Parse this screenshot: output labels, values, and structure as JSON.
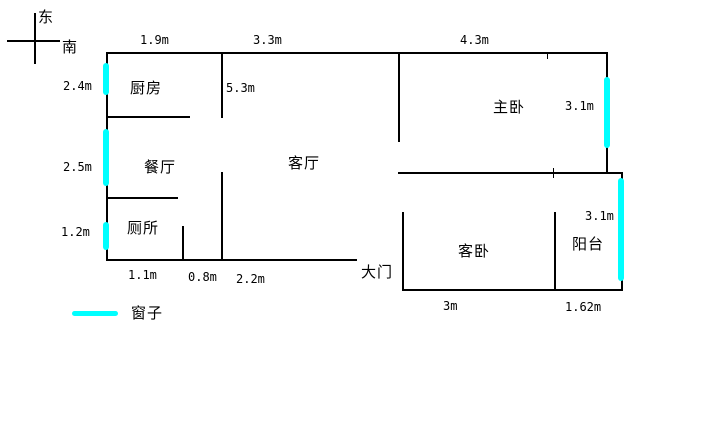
{
  "compass": {
    "east": "东",
    "south": "南"
  },
  "rooms": {
    "kitchen": "厨房",
    "dining": "餐厅",
    "toilet": "厕所",
    "living": "客厅",
    "master_bedroom": "主卧",
    "guest_bedroom": "客卧",
    "balcony": "阳台"
  },
  "door": {
    "main": "大门"
  },
  "legend": {
    "window_label": "窗子"
  },
  "dimensions": {
    "top_kitchen": "1.9m",
    "top_living": "3.3m",
    "top_master": "4.3m",
    "left_kitchen": "2.4m",
    "left_dining": "2.5m",
    "left_toilet": "1.2m",
    "kitchen_wall": "5.3m",
    "master_window": "3.1m",
    "balcony_window": "3.1m",
    "bottom_toilet": "1.1m",
    "bottom_gap": "0.8m",
    "bottom_living": "2.2m",
    "bottom_guest": "3m",
    "bottom_balcony": "1.62m"
  },
  "colors": {
    "wall": "#000000",
    "window": "#00ffff",
    "background": "#ffffff"
  }
}
